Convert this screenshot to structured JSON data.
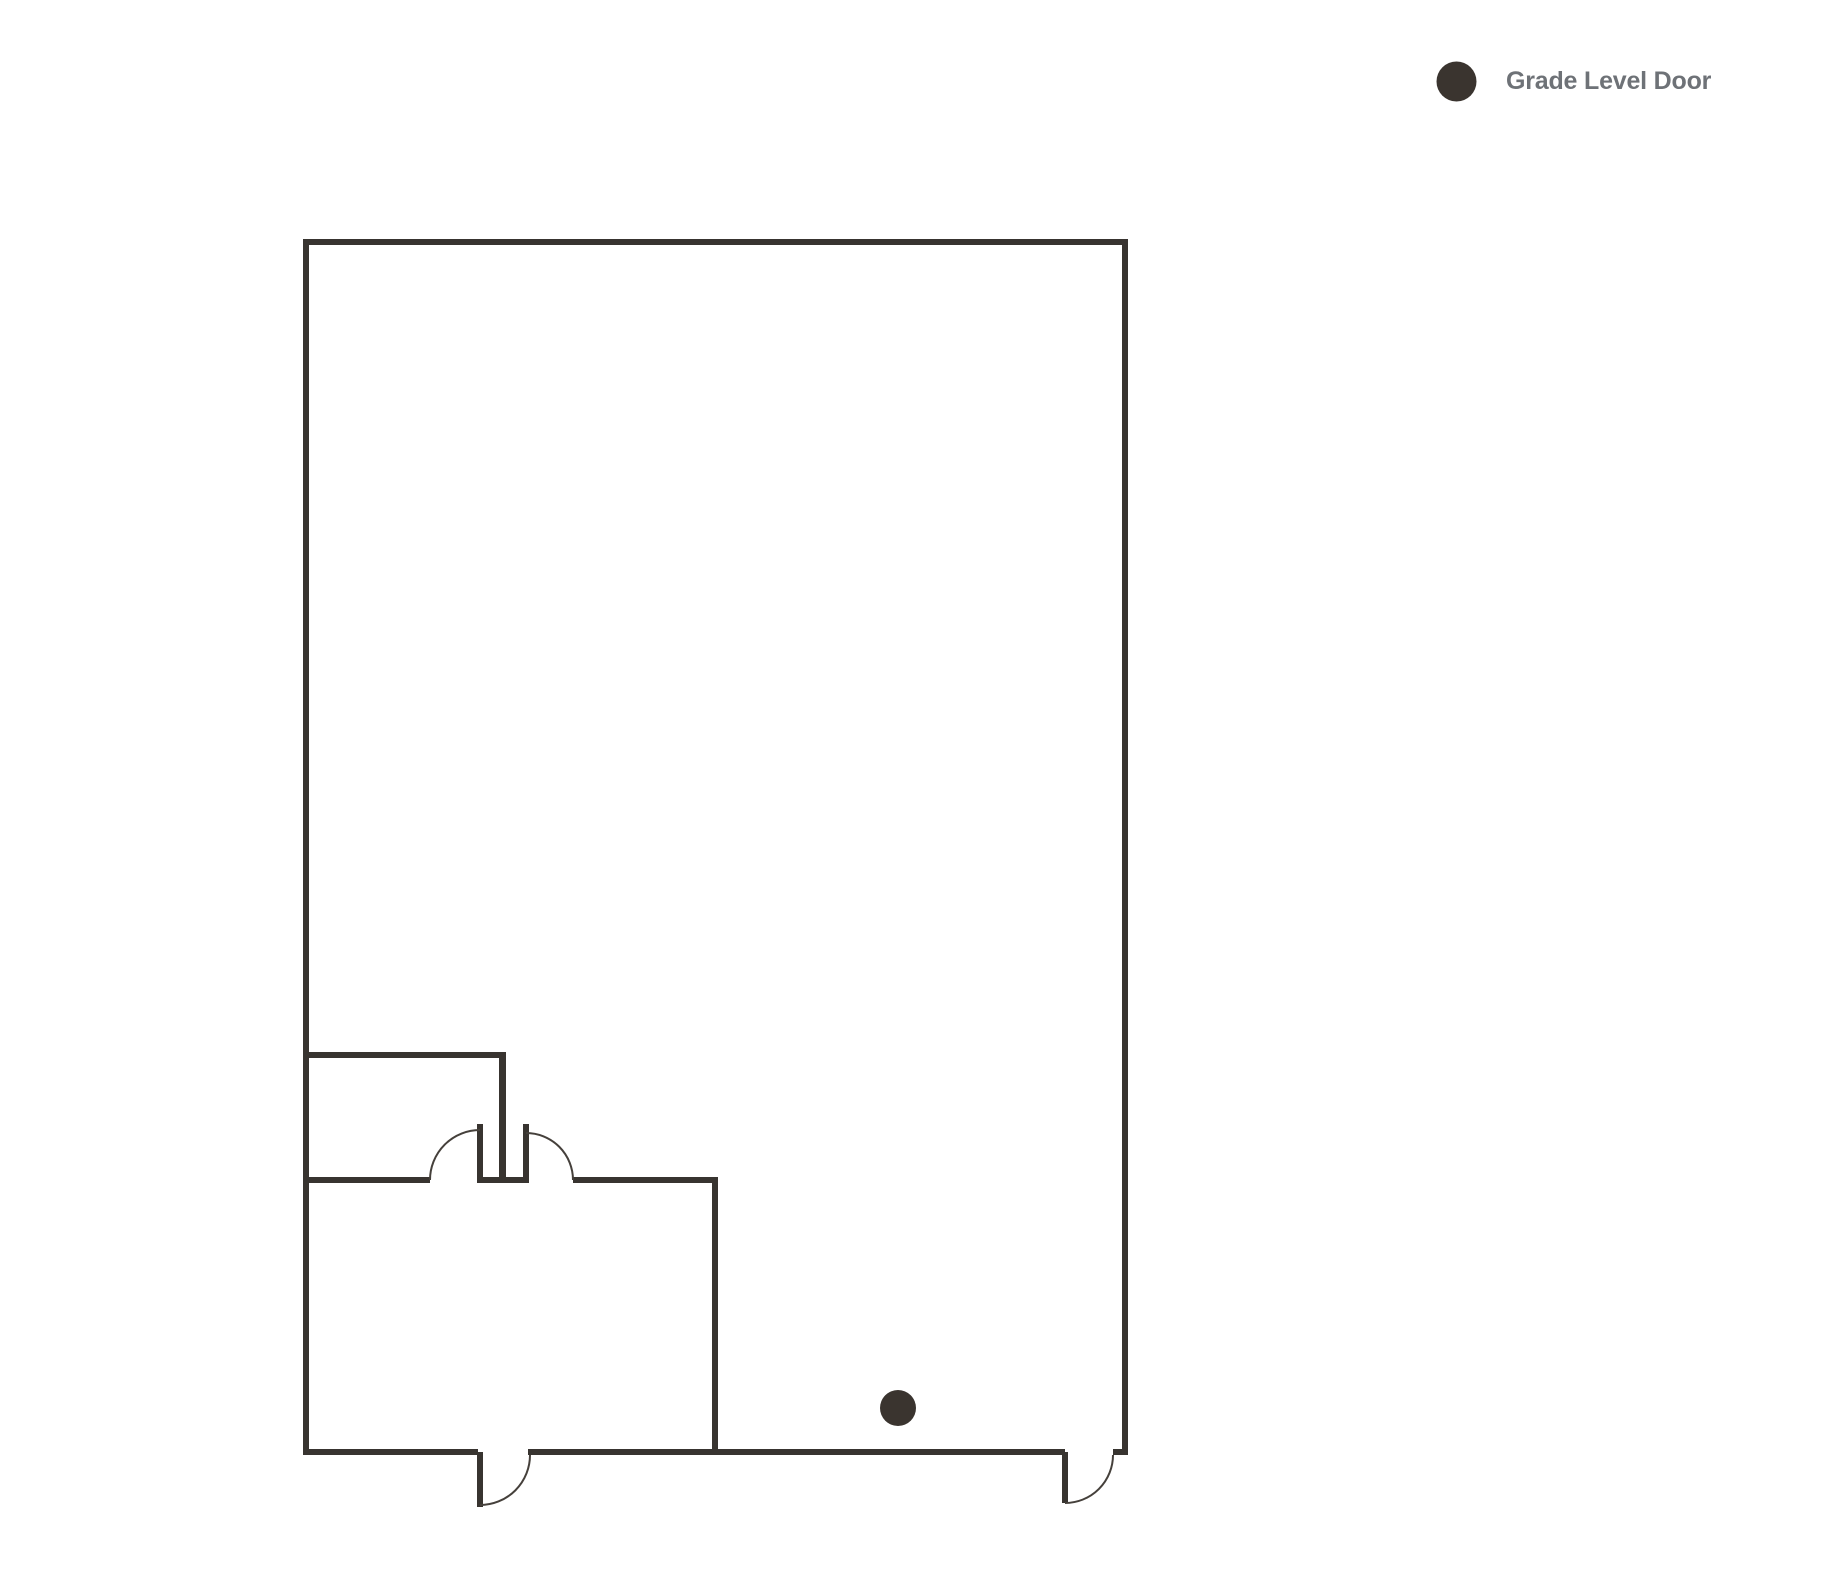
{
  "legend": {
    "items": [
      {
        "label": "Grade Level Door",
        "marker_color": "#3a342f"
      }
    ]
  },
  "colors": {
    "background": "#ffffff",
    "wall": "#383430",
    "door_arc": "#45403b",
    "legend_text": "#6e7277"
  },
  "floorplan": {
    "markers": [
      {
        "name": "grade-level-door",
        "cx": 898,
        "cy": 1408,
        "r": 18,
        "fill": "#3a342f"
      }
    ]
  }
}
